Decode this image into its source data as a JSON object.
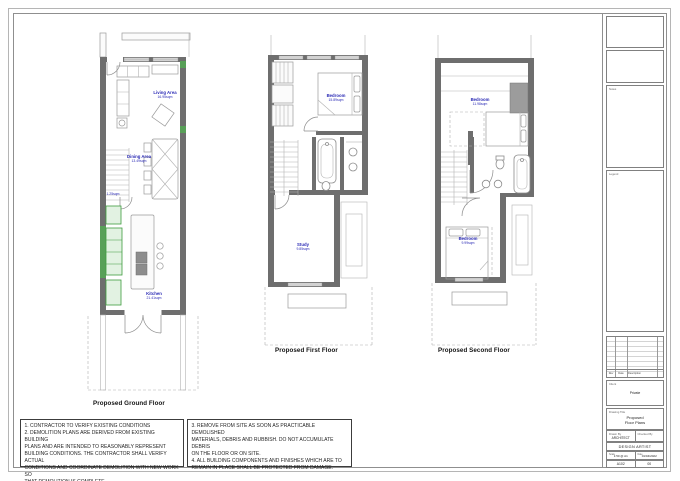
{
  "plans": [
    {
      "title": "Proposed Ground Floor",
      "rooms": {
        "living": {
          "name": "Living Area",
          "area": "16.95sqm"
        },
        "dining": {
          "name": "Dining Area",
          "area": "13.49sqm"
        },
        "wc": {
          "area": "1.25sqm"
        },
        "kitchen": {
          "name": "Kitchen",
          "area": "21.41sqm"
        }
      }
    },
    {
      "title": "Proposed First Floor",
      "rooms": {
        "bedroom": {
          "name": "Bedroom",
          "area": "15.89sqm"
        },
        "study": {
          "name": "Study",
          "area": "9.85sqm"
        }
      }
    },
    {
      "title": "Proposed Second Floor",
      "rooms": {
        "bedroom1": {
          "name": "Bedroom",
          "area": "11.98sqm"
        },
        "bedroom2": {
          "name": "Bedroom",
          "area": "9.99sqm"
        }
      }
    }
  ],
  "notes": {
    "left": "1. CONTRACTOR TO VERIFY EXISTING CONDITIONS\n2. DEMOLITION PLANS ARE DERIVED FROM EXISTING BUILDING\nPLANS AND ARE INTENDED TO REASONABLY REPRESENT\nBUILDING CONDITIONS.  THE CONTRACTOR SHALL VERIFY ACTUAL\nCONDITIONS AND COORDINATE DEMOLITION WITH NEW WORK SO\nTHAT DEMOLITION IS COMPLETE.",
    "right": "3. REMOVE FROM SITE AS SOON AS PRACTICABLE DEMOLISHED\nMATERIALS, DEBRIS AND RUBBISH.  DO NOT ACCUMULATE DEBRIS\nON THE FLOOR OR ON SITE.\n4. ALL BUILDING COMPONENTS AND FINISHES WHICH ARE TO\nREMAIN IN PLACE SHALL BE PROTECTED FROM DAMAGE."
  },
  "titleblock": {
    "notes_label": "Notes",
    "legend_label": "Legend",
    "revision": {
      "rev_label": "Rev",
      "date_label": "Date",
      "desc_label": "Description"
    },
    "client_label": "Client",
    "client": "Private",
    "title_label": "Drawing Title",
    "drawing_title": "Proposed\nFloor Plans",
    "drawn_label": "Drawn By",
    "drawn": "ARCHITECT",
    "checked_label": "Checked By",
    "checked": "",
    "company": "DESIGN ARTIST",
    "scale_label": "Scale",
    "scale": "1:50 @ A1",
    "date_label": "Date",
    "date": "01/04/2022",
    "number_label": "Drawing No.",
    "number": "A102",
    "rev_label": "Rev",
    "rev": "00"
  }
}
